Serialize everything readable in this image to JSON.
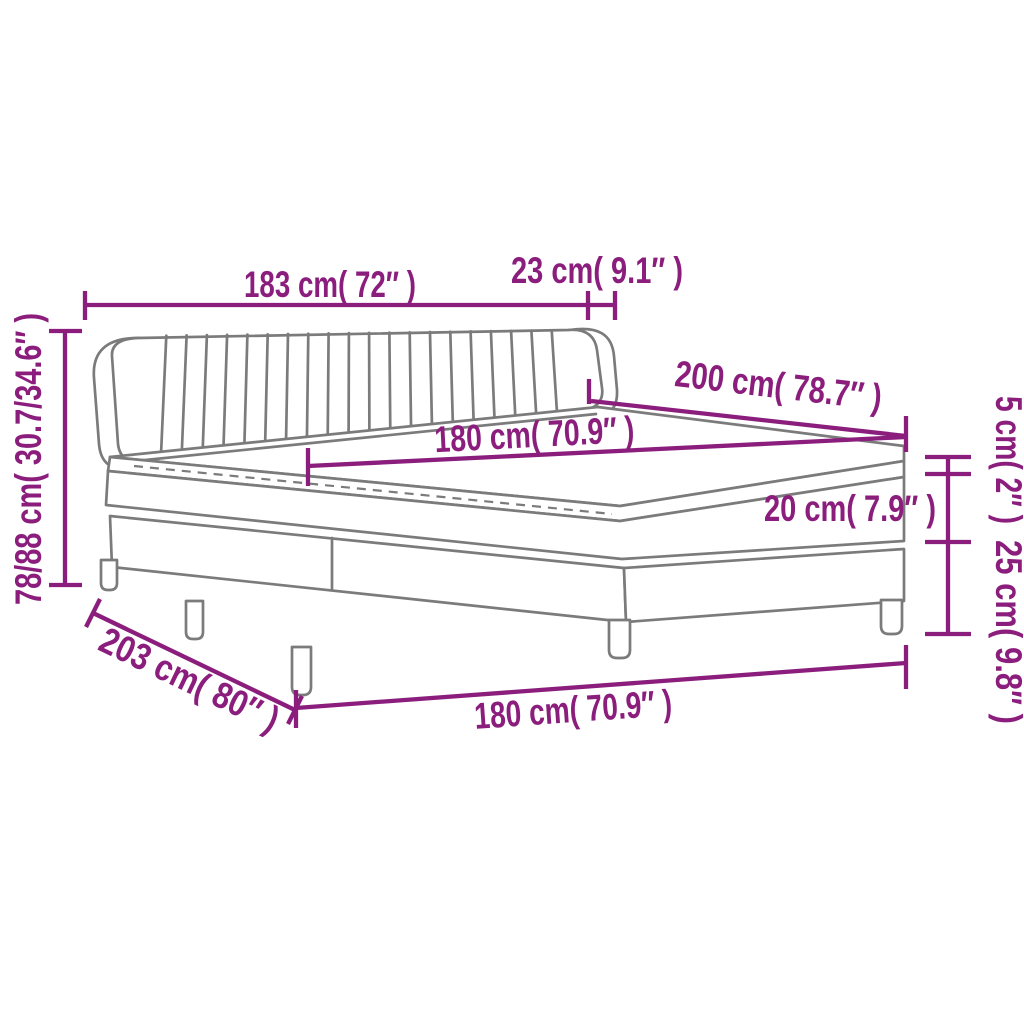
{
  "diagram": {
    "colors": {
      "dimension_color": "#8B1E7D",
      "outline_color": "#7B7B7B",
      "background_color": "#FFFFFF"
    },
    "dimensions": {
      "headboard_width": "183 cm( 72″ )",
      "headboard_side_depth": "23 cm( 9.1″ )",
      "total_height_range": "78/88 cm( 30.7/34.6″ )",
      "bed_length": "200 cm( 78.7″ )",
      "mattress_width_top": "180 cm( 70.9″ )",
      "topper_thickness": "5 cm( 2″ )",
      "mattress_thickness": "20 cm( 7.9″ )",
      "base_and_leg_height": "25 cm( 9.8″ )",
      "base_diagonal_length": "203 cm( 80″ )",
      "base_width_bottom": "180 cm( 70.9″ )"
    }
  }
}
